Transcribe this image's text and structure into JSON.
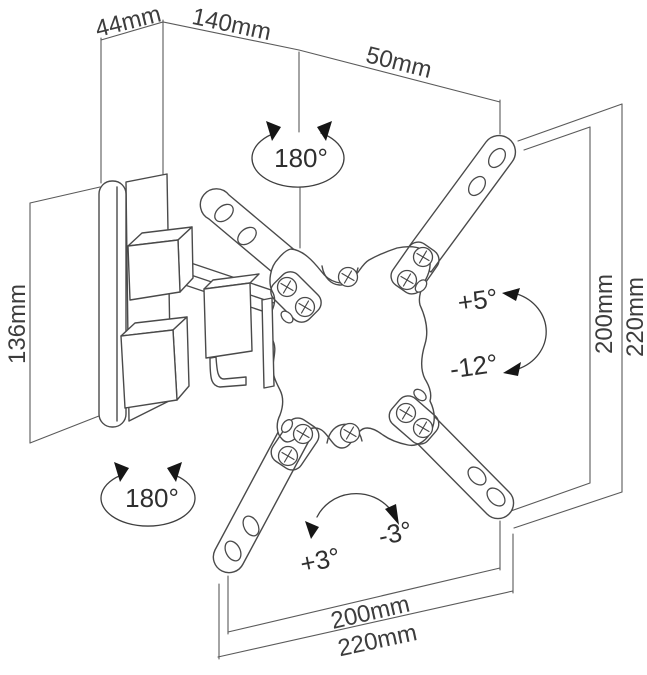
{
  "diagram": {
    "colors": {
      "background": "#ffffff",
      "line": "#4a4a4a",
      "dimension_line": "#5a5a5a",
      "text": "#3d3d3d"
    },
    "dims": {
      "top": [
        {
          "label": "44mm"
        },
        {
          "label": "140mm"
        },
        {
          "label": "50mm"
        }
      ],
      "left": {
        "label": "136mm"
      },
      "right": [
        {
          "label": "200mm"
        },
        {
          "label": "220mm"
        }
      ],
      "bottom": [
        {
          "label": "200mm"
        },
        {
          "label": "220mm"
        }
      ]
    },
    "angles": {
      "top_swivel": {
        "label": "180°"
      },
      "bottom_swivel": {
        "label": "180°"
      },
      "tilt_up": {
        "label": "+5°"
      },
      "tilt_down": {
        "label": "-12°"
      },
      "swivel_plus": {
        "label": "+3°"
      },
      "swivel_minus": {
        "label": "-3°"
      }
    }
  }
}
